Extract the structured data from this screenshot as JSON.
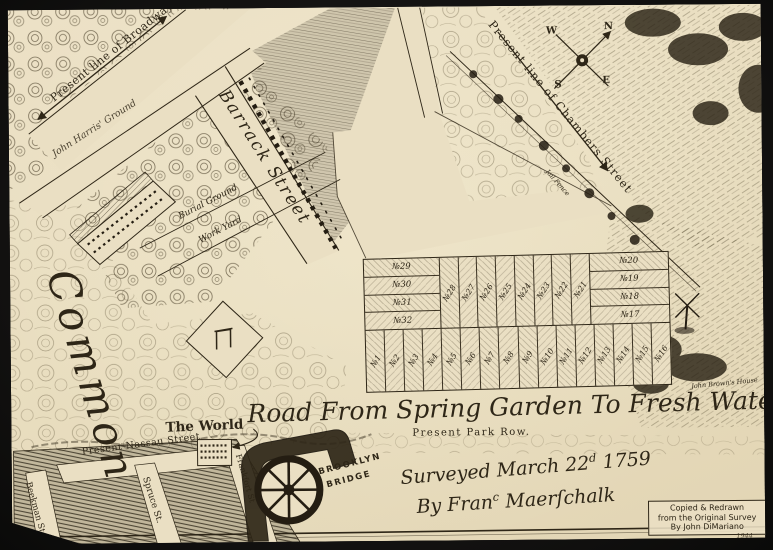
{
  "colors": {
    "photo_background": "#121110",
    "paper": "#e9dec2",
    "ink": "#2e2617"
  },
  "compass": {
    "n": "N",
    "w": "W",
    "s": "S",
    "e": "E"
  },
  "streets": {
    "broadway": "Present line of Broadway",
    "chambers": "Present line of Chambers Street",
    "barrack": "Barrack Street",
    "nassau": "Present Nassau Street",
    "spruce": "Spruce St.",
    "beekman": "Beekman St",
    "frankfort": "Frankfort St",
    "park_row": "Present Park Row."
  },
  "places": {
    "common": "Common",
    "harris_ground": "John Harris' Ground",
    "burial_ground": "Burial Ground",
    "work_yard": "Work Yard",
    "jail_fence": "Jail Fence",
    "john_browns_house": "John Brown's House",
    "the_world": "The World",
    "brooklyn_bridge_line1": "BROOKLYN",
    "brooklyn_bridge_line2": "BRIDGE",
    "road_title": "Road From Spring Garden To Fresh Water"
  },
  "survey": {
    "line1_pre": "Surveyed March 22",
    "line1_sup": "d",
    "line1_post": " 1759",
    "line2_pre": "By Fran",
    "line2_sup": "c",
    "line2_post": " Maerſchalk"
  },
  "credit": {
    "line1": "Copied & Redrawn",
    "line2": "from the Original Survey",
    "line3": "By John DiMariano",
    "year": "1944"
  },
  "lots": {
    "left_rows": [
      "№29",
      "№30",
      "№31",
      "№32"
    ],
    "middle_cols": [
      "№28",
      "№27",
      "№26",
      "№25",
      "№24",
      "№23",
      "№22",
      "№21"
    ],
    "right_rows": [
      "№20",
      "№19",
      "№18",
      "№17"
    ],
    "bottom_cols": [
      "№1",
      "№2",
      "№3",
      "№4",
      "№5",
      "№6",
      "№7",
      "№8",
      "№9",
      "№10",
      "№11",
      "№12",
      "№13",
      "№14",
      "№15",
      "№16"
    ]
  }
}
